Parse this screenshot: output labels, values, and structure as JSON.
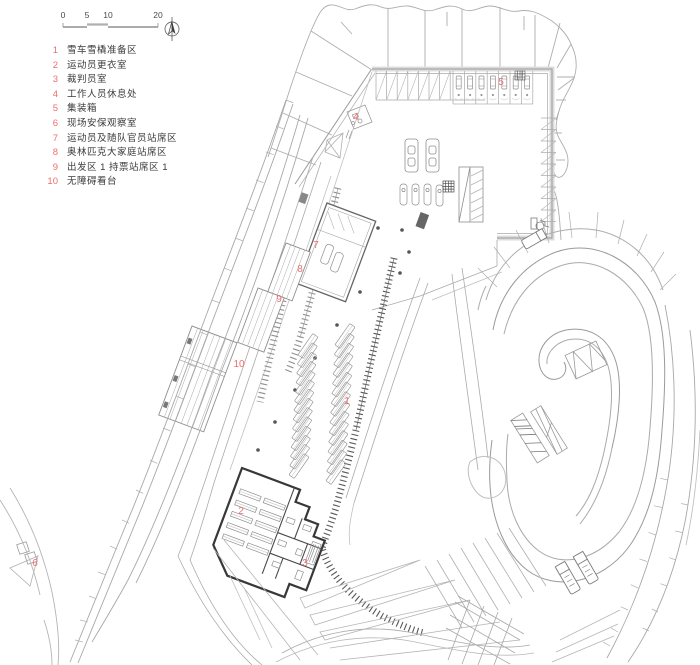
{
  "title": "竞赛场馆出发区平面图",
  "colors": {
    "marker_red": "#ee6f6f",
    "legend_text": "#3a3a3a",
    "line_light": "#b5b5b5",
    "line_mid": "#8f8f8f",
    "line_dark": "#4a4a4a",
    "wall_dark": "#383838",
    "plaza_border": "#d8d8d8"
  },
  "scalebar": {
    "labels": [
      "0",
      "5",
      "10",
      "20"
    ]
  },
  "north_arrow": {
    "name": "north-arrow"
  },
  "legend": {
    "items": [
      {
        "num": "1",
        "label": "雪车雪橇准备区"
      },
      {
        "num": "2",
        "label": "运动员更衣室"
      },
      {
        "num": "3",
        "label": "裁判员室"
      },
      {
        "num": "4",
        "label": "工作人员休息处"
      },
      {
        "num": "5",
        "label": "集装箱"
      },
      {
        "num": "6",
        "label": "现场安保观察室"
      },
      {
        "num": "7",
        "label": "运动员及随队官员站席区"
      },
      {
        "num": "8",
        "label": "奥林匹克大家庭站席区"
      },
      {
        "num": "9",
        "label": "出发区 1 持票站席区 1"
      },
      {
        "num": "10",
        "label": "无障碍看台"
      }
    ]
  },
  "plan_markers": [
    {
      "num": "1",
      "x": 347,
      "y": 404
    },
    {
      "num": "2",
      "x": 241,
      "y": 514
    },
    {
      "num": "3",
      "x": 305,
      "y": 566
    },
    {
      "num": "4",
      "x": 356,
      "y": 120
    },
    {
      "num": "5",
      "x": 501,
      "y": 85
    },
    {
      "num": "6",
      "x": 35,
      "y": 566
    },
    {
      "num": "7",
      "x": 316,
      "y": 248
    },
    {
      "num": "8",
      "x": 300,
      "y": 272
    },
    {
      "num": "9",
      "x": 279,
      "y": 302
    },
    {
      "num": "10",
      "x": 239,
      "y": 367
    }
  ]
}
